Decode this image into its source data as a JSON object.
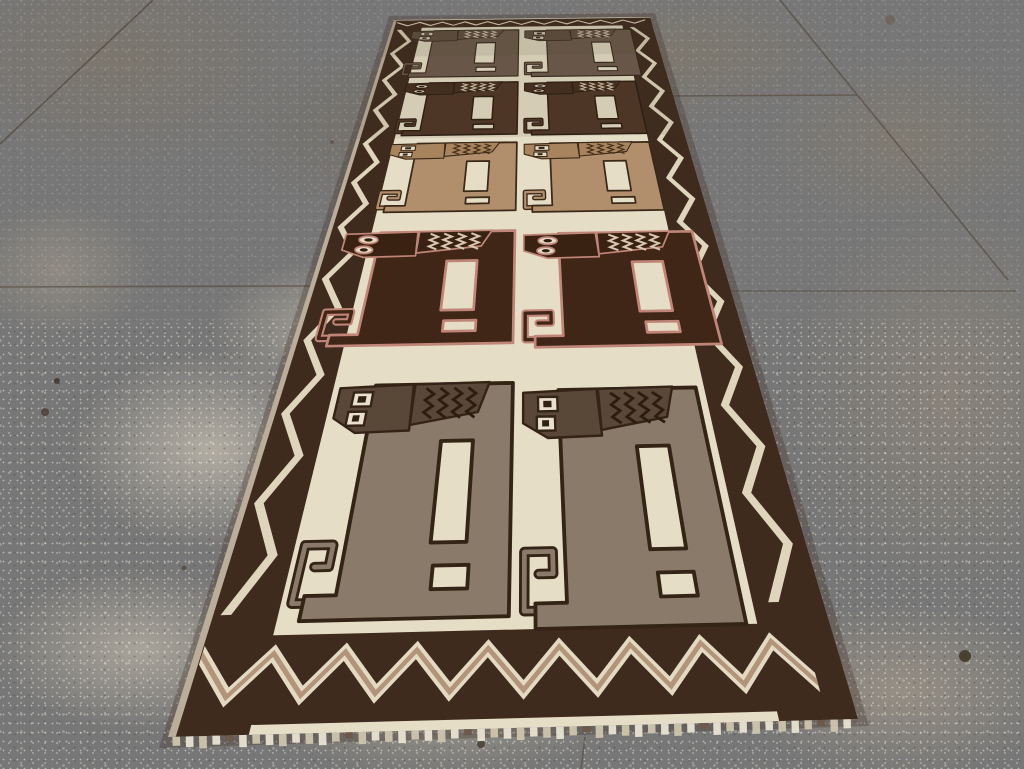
{
  "scene": {
    "description": "Photograph of a vintage tribal runner rug with ten stylized lion figures in two columns, lying in perspective on a speckled concrete floor",
    "subject": "pictorial lion gabbeh runner rug",
    "figure_count": 10,
    "figure_rows": 5,
    "figure_columns": 2
  },
  "floor": {
    "base_top": "#8d806b",
    "base_bottom": "#b2a58f",
    "stains": [
      {
        "x": 460,
        "y": 130,
        "rx": 350,
        "ry": 130,
        "color": "rgba(116,104,88,0.55)"
      },
      {
        "x": 120,
        "y": 60,
        "rx": 270,
        "ry": 150,
        "color": "rgba(128,116,99,0.50)"
      },
      {
        "x": 680,
        "y": 55,
        "rx": 230,
        "ry": 95,
        "color": "rgba(134,121,100,0.45)"
      },
      {
        "x": 905,
        "y": 140,
        "rx": 200,
        "ry": 120,
        "color": "rgba(139,127,106,0.42)"
      },
      {
        "x": 210,
        "y": 450,
        "rx": 200,
        "ry": 140,
        "color": "rgba(214,206,189,0.62)"
      },
      {
        "x": 330,
        "y": 330,
        "rx": 170,
        "ry": 100,
        "color": "rgba(208,199,180,0.50)"
      },
      {
        "x": 140,
        "y": 650,
        "rx": 210,
        "ry": 115,
        "color": "rgba(209,200,182,0.55)"
      },
      {
        "x": 440,
        "y": 710,
        "rx": 260,
        "ry": 95,
        "color": "rgba(196,185,162,0.45)"
      },
      {
        "x": 950,
        "y": 400,
        "rx": 230,
        "ry": 270,
        "color": "rgba(162,148,126,0.40)"
      },
      {
        "x": 900,
        "y": 690,
        "rx": 230,
        "ry": 125,
        "color": "rgba(180,167,145,0.50)"
      },
      {
        "x": 60,
        "y": 270,
        "rx": 130,
        "ry": 95,
        "color": "rgba(181,168,147,0.40)"
      }
    ],
    "grout_lines": [
      {
        "x1": 153,
        "y1": 0,
        "x2": 0,
        "y2": 144,
        "o": 0.6
      },
      {
        "x1": 0,
        "y1": 287,
        "x2": 312,
        "y2": 286,
        "o": 0.5
      },
      {
        "x1": 660,
        "y1": 96,
        "x2": 857,
        "y2": 95,
        "o": 0.5
      },
      {
        "x1": 780,
        "y1": 0,
        "x2": 1008,
        "y2": 280,
        "o": 0.55
      },
      {
        "x1": 729,
        "y1": 291,
        "x2": 1016,
        "y2": 291,
        "o": 0.45
      },
      {
        "x1": 585,
        "y1": 737,
        "x2": 581,
        "y2": 769,
        "o": 0.5
      }
    ],
    "grout_color": "#4a3f31",
    "spots": [
      {
        "x": 965,
        "y": 656,
        "r": 6,
        "c": "#413828",
        "o": 0.9
      },
      {
        "x": 795,
        "y": 561,
        "r": 3,
        "c": "#4a4034",
        "o": 0.8
      },
      {
        "x": 890,
        "y": 20,
        "r": 5,
        "c": "#6a5e4d",
        "o": 0.6
      },
      {
        "x": 57,
        "y": 381,
        "r": 3,
        "c": "#39302a",
        "o": 0.8
      },
      {
        "x": 45,
        "y": 412,
        "r": 4,
        "c": "#443a2e",
        "o": 0.75
      },
      {
        "x": 481,
        "y": 744,
        "r": 4,
        "c": "#453c30",
        "o": 0.8
      },
      {
        "x": 536,
        "y": 93,
        "r": 2.5,
        "c": "#554a3c",
        "o": 0.7
      },
      {
        "x": 332,
        "y": 142,
        "r": 2,
        "c": "#5a4f41",
        "o": 0.7
      },
      {
        "x": 184,
        "y": 568,
        "r": 2.5,
        "c": "#4e4334",
        "o": 0.7
      }
    ]
  },
  "rug": {
    "quad": {
      "tl": [
        394,
        20
      ],
      "tr": [
        650,
        17
      ],
      "br": [
        858,
        719
      ],
      "bl": [
        168,
        737
      ]
    },
    "flat": {
      "w": 640,
      "h": 2340
    },
    "field_color": "#e6ddc7",
    "border_color": "#3e2b1e",
    "selvage_color": "#d9cfb9",
    "shadow_color": "rgba(58,44,32,0.30)",
    "borders": {
      "side_w": 74,
      "top": [
        6,
        70
      ],
      "bottom": [
        2208,
        2328
      ]
    },
    "zigzag": {
      "side_color": "#dfd4bc",
      "side_u": [
        20,
        52
      ],
      "side_period": 190,
      "side_halfw": 5.5,
      "top_color": "#ded2ba",
      "top_v": [
        24,
        52
      ],
      "top_period": 56,
      "top_halfw": 5,
      "bottom_color": "#e4dac2",
      "bottom_core_color": "#b2947a",
      "bottom_v": [
        2234,
        2292
      ],
      "bottom_period": 71,
      "bottom_halfw": 13,
      "bottom_core_halfw": 5
    },
    "fringe": {
      "color_a": "#e9e3d3",
      "color_b": "#cfc5ae",
      "color_dark": "#6b5948",
      "len": 9
    },
    "shade_far": "rgba(70,56,44,0.10)",
    "columns": {
      "left_right_edge": 316,
      "right_left_edge": 326
    },
    "rows": [
      {
        "label": "pair-1-far",
        "v": 90,
        "sx": 1.09,
        "sy": 0.8,
        "right_dv": 6,
        "body": "#6d5b4c",
        "head": "#5f4e3e",
        "outline": "#35261a",
        "chevron": "#d6cab4",
        "eye_white": "#dcd2bf",
        "eye_pupil": "#3a2b1e",
        "eye_shape": "square",
        "stroke": 0.7,
        "chev_w": 0.8,
        "tail_w": 3.2
      },
      {
        "label": "pair-2",
        "v": 482,
        "sx": 1.02,
        "sy": 0.72,
        "right_dv": 6,
        "body": "#4e3625",
        "head": "#452d1d",
        "outline": "#2b1c10",
        "chevron": "#d3c6ae",
        "eye_white": "#d8cdb8",
        "eye_pupil": "#30200f",
        "eye_shape": "round",
        "stroke": 0.9,
        "chev_w": 1.0,
        "tail_w": 4.0
      },
      {
        "label": "pair-3",
        "v": 842,
        "sx": 1.02,
        "sy": 0.73,
        "right_dv": 8,
        "body": "#b18e6c",
        "head": "#a7845e",
        "outline": "#3b2918",
        "chevron": "#46301a",
        "eye_white": "#e5dcc8",
        "eye_pupil": "#33220f",
        "eye_shape": "square",
        "stroke": 1.1,
        "chev_w": 1.2,
        "tail_w": 5.0
      },
      {
        "label": "pair-4",
        "v": 1243,
        "sx": 1.18,
        "sy": 0.85,
        "right_dv": 14,
        "body": "#402616",
        "head": "#3a2212",
        "outline": "#c08579",
        "chevron": "#d7c6b0",
        "eye_white": "#e4dbc7",
        "eye_pupil": "#2f1d0d",
        "eye_shape": "round",
        "stroke": 1.7,
        "chev_w": 2.0,
        "tail_w": 7.5
      },
      {
        "label": "pair-5-near",
        "v": 1722,
        "sx": 0.97,
        "sy": 1.04,
        "right_dv": 20,
        "body": "#8a7a69",
        "head": "#594737",
        "outline": "#342416",
        "chevron": "#2b1d10",
        "eye_white": "#e9e1cd",
        "eye_pupil": "#302212",
        "eye_shape": "square",
        "stroke": 2.4,
        "chev_w": 2.8,
        "tail_w": 10.5
      }
    ]
  }
}
